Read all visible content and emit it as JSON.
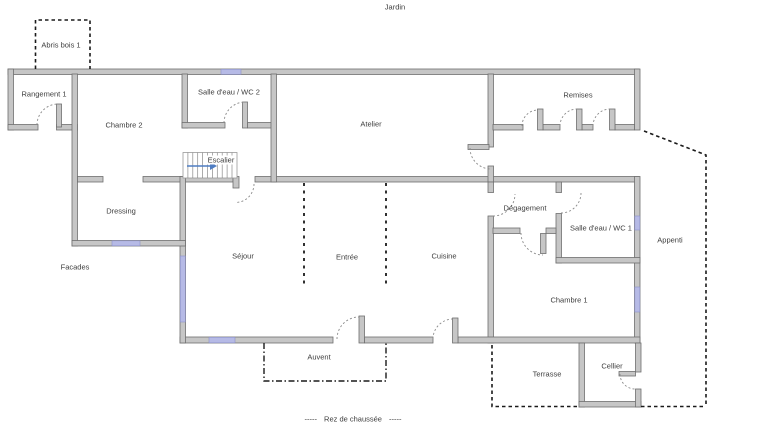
{
  "header": {
    "area_label_top": "Jardin"
  },
  "footer": {
    "dashes": "-----",
    "label": "Rez de chaussée"
  },
  "rooms": {
    "abris_bois": "Abris bois 1",
    "rangement": "Rangement 1",
    "chambre_2": "Chambre 2",
    "salle_eau_wc_2": "Salle d'eau / WC 2",
    "atelier": "Atelier",
    "remises": "Remises",
    "escalier": "Escalier",
    "dressing": "Dressing",
    "facades": "Facades",
    "sejour": "Séjour",
    "entree": "Entrée",
    "cuisine": "Cuisine",
    "degagement": "Dégagement",
    "salle_eau_wc_1": "Salle d'eau / WC 1",
    "appenti": "Appenti",
    "chambre_1": "Chambre 1",
    "auvent": "Auvent",
    "terrasse": "Terrasse",
    "cellier": "Cellier"
  },
  "colors": {
    "background": "#ffffff",
    "wall_fill": "#c6c6c6",
    "wall_stroke": "#6e6e6e",
    "window_fill": "#b6bae6",
    "window_stroke": "#8d92c8",
    "door_arc": "#8a8a8a",
    "dashed_line": "#1a1a1a",
    "stair_arrow": "#4f7dc2",
    "text": "#3d3d3d"
  }
}
